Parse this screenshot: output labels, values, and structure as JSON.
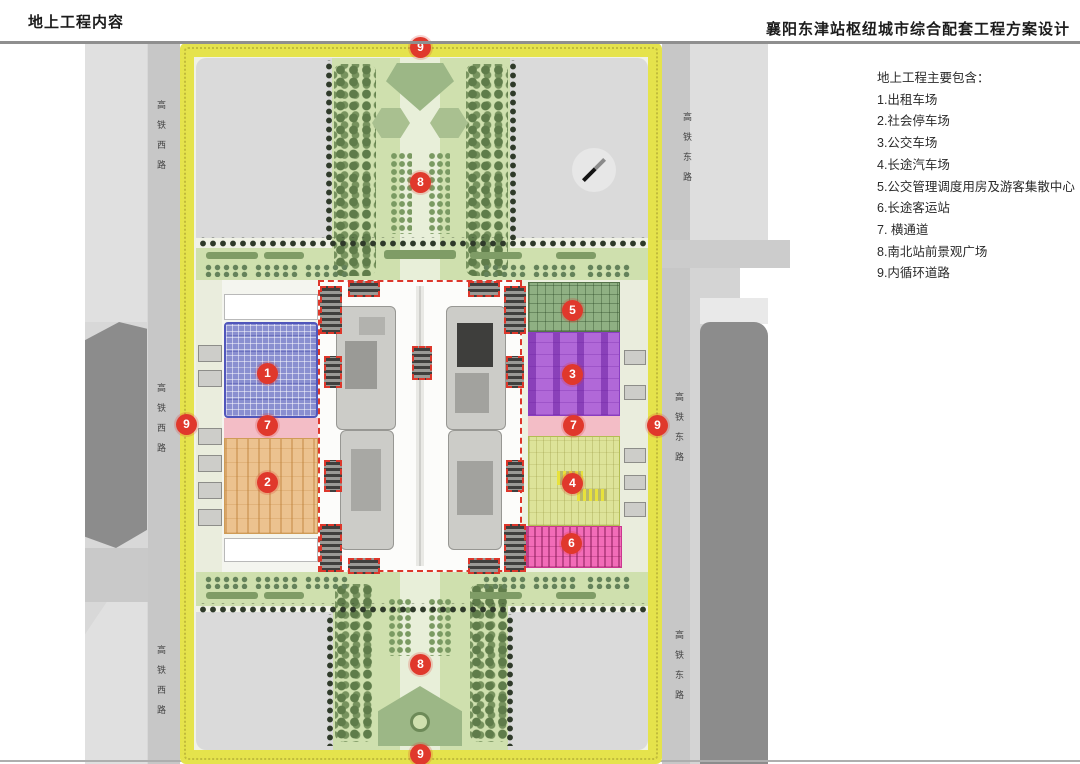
{
  "header": {
    "left_title": "地上工程内容",
    "right_title": "襄阳东津站枢纽城市综合配套工程方案设计"
  },
  "legend": {
    "heading": "地上工程主要包含：",
    "items": [
      "1.出租车场",
      "2.社会停车场",
      "3.公交车场",
      "4.长途汽车场",
      "5.公交管理调度用房及游客集散中心",
      "6.长途客运站",
      "7. 横通道",
      "8.南北站前景观广场",
      "9.内循环道路"
    ]
  },
  "roads": {
    "west_label": "高铁西路",
    "east_label": "高铁东路"
  },
  "plan": {
    "markers": [
      {
        "id": "ring-top",
        "label": "9"
      },
      {
        "id": "north-plaza",
        "label": "8"
      },
      {
        "id": "ring-left",
        "label": "9"
      },
      {
        "id": "taxi-zone",
        "label": "1"
      },
      {
        "id": "passage-west",
        "label": "7"
      },
      {
        "id": "public-parking",
        "label": "2"
      },
      {
        "id": "dispatch-center",
        "label": "5"
      },
      {
        "id": "bus-yard",
        "label": "3"
      },
      {
        "id": "passage-east",
        "label": "7"
      },
      {
        "id": "ring-right",
        "label": "9"
      },
      {
        "id": "coach-yard",
        "label": "4"
      },
      {
        "id": "coach-station",
        "label": "6"
      },
      {
        "id": "south-plaza",
        "label": "8"
      },
      {
        "id": "ring-bottom",
        "label": "9"
      }
    ],
    "zone_colors": {
      "taxi": "#8a8fd0",
      "public_parking": "#ecc28f",
      "bus_yard": "#b168d8",
      "coach_yard": "#dde399",
      "dispatch_center": "#8fb083",
      "coach_station": "#f26cb8",
      "passage": "#f3bdc6",
      "ring_road": "#e5e34c",
      "marker_red": "#e0382c",
      "plaza_green": "#cfe0ae"
    }
  }
}
